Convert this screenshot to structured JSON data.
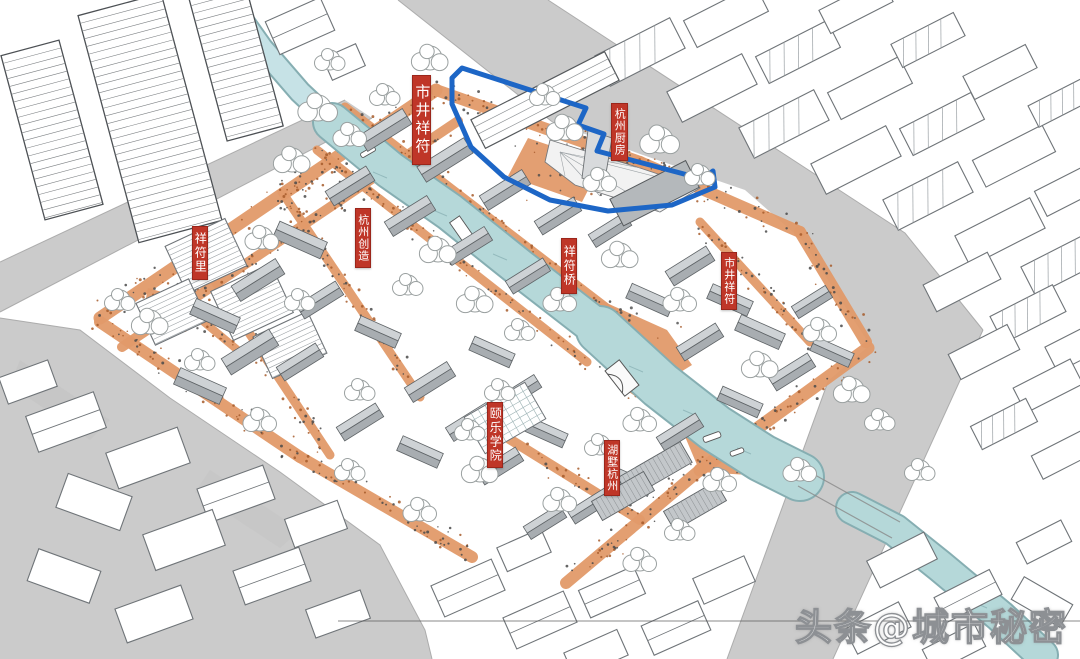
{
  "labels": [
    {
      "id": "shijing-xiangfu-nw",
      "text": "市井祥符"
    },
    {
      "id": "hangzhou-chufang",
      "text": "杭州厨房"
    },
    {
      "id": "hangzhou-chuangzao",
      "text": "杭州创造"
    },
    {
      "id": "xiangfu-li",
      "text": "祥符里"
    },
    {
      "id": "xiangfu-qiao",
      "text": "祥符桥"
    },
    {
      "id": "shijing-xiangfu-east",
      "text": "市井祥符"
    },
    {
      "id": "yile-xueyuan",
      "text": "颐乐学院"
    },
    {
      "id": "hushu-hangzhou",
      "text": "湖墅杭州"
    }
  ],
  "watermark": {
    "text": "头条@城市秘密"
  },
  "colors": {
    "label_red": "#bf3628",
    "label_text": "#ffffff",
    "highlight_blue": "#1d66c6",
    "water": "#b5d8d9",
    "water_light": "#c6e2e6",
    "water_edge": "#86aeb2",
    "street_orange": "#e29a6a",
    "road_gray": "#cbcbcb",
    "roof_light": "#ced2d5",
    "roof_dark": "#a8adb1",
    "line_dark": "#5e6366",
    "sketch_line": "#6f7478",
    "tree_line": "#9aa0a0",
    "speckle_brown": "#a65a2a",
    "speckle_dark": "#4a4a4a"
  }
}
